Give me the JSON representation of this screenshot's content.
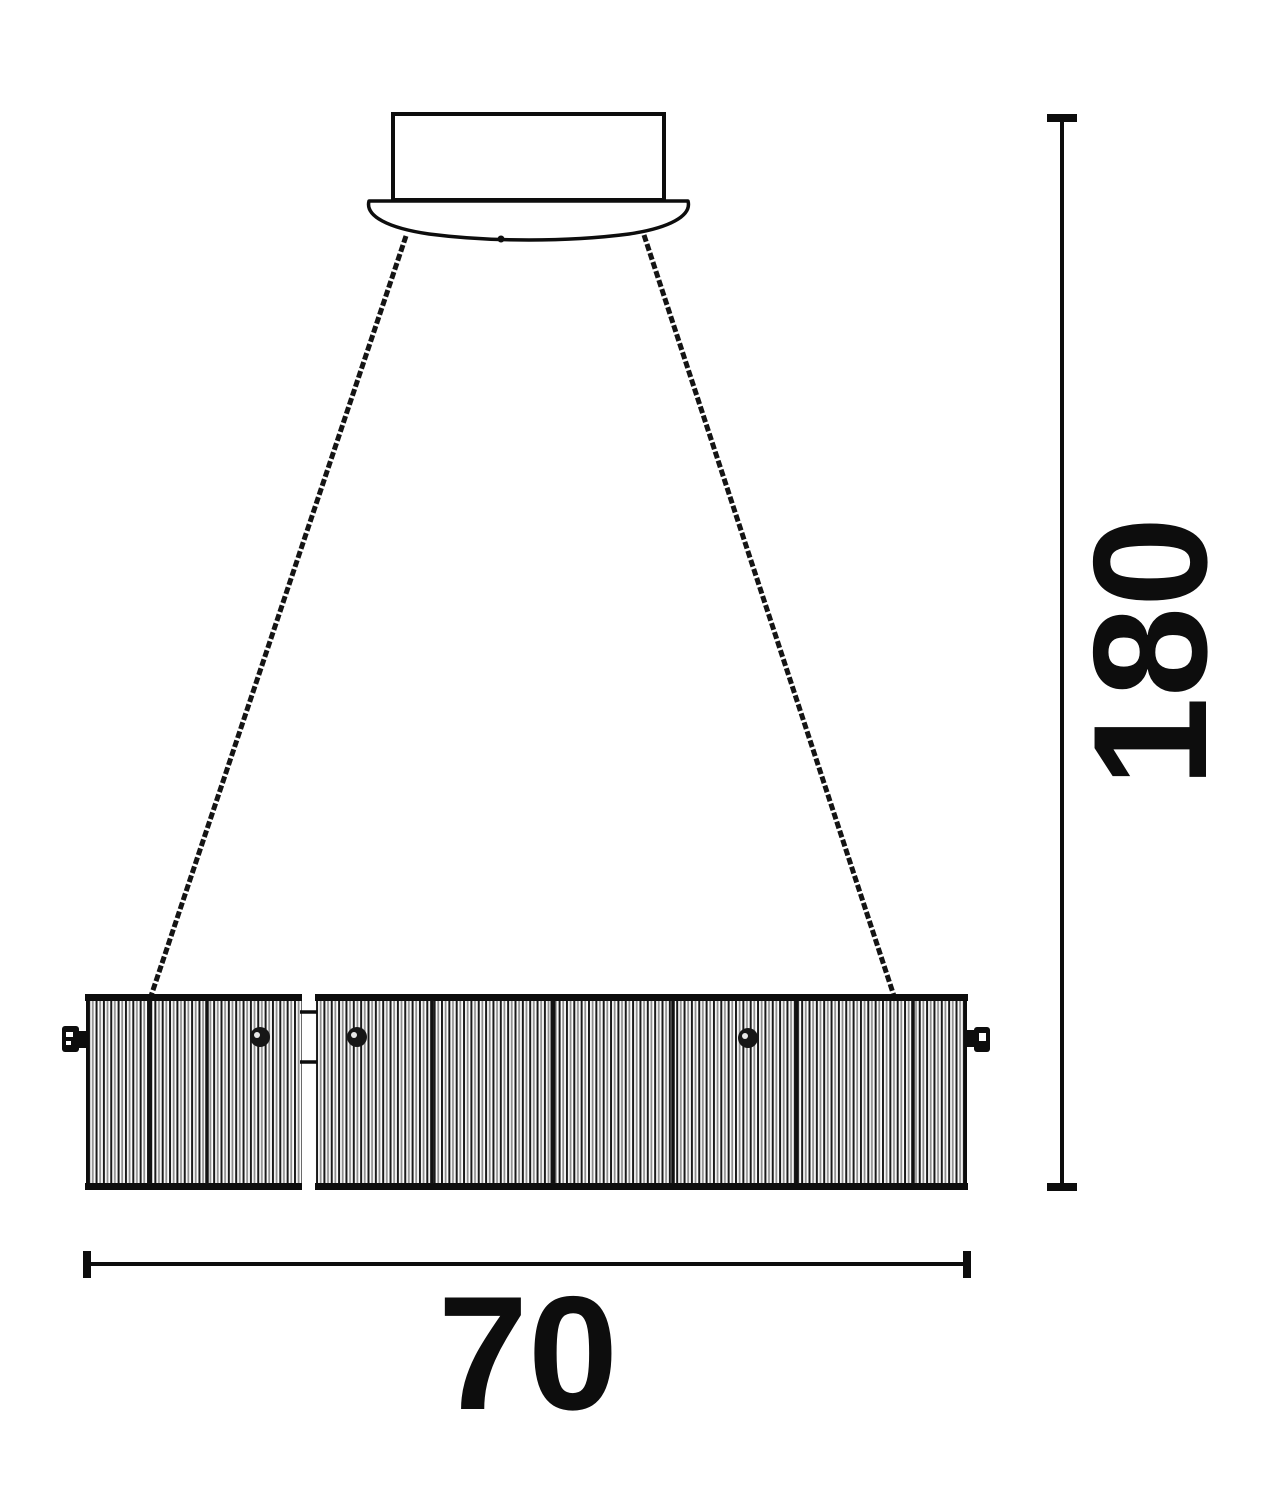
{
  "page": {
    "background": "#ffffff",
    "ink": "#0d0d0d",
    "rib_gray": "#8f8f8f"
  },
  "labels": {
    "height": "180",
    "width": "70"
  }
}
